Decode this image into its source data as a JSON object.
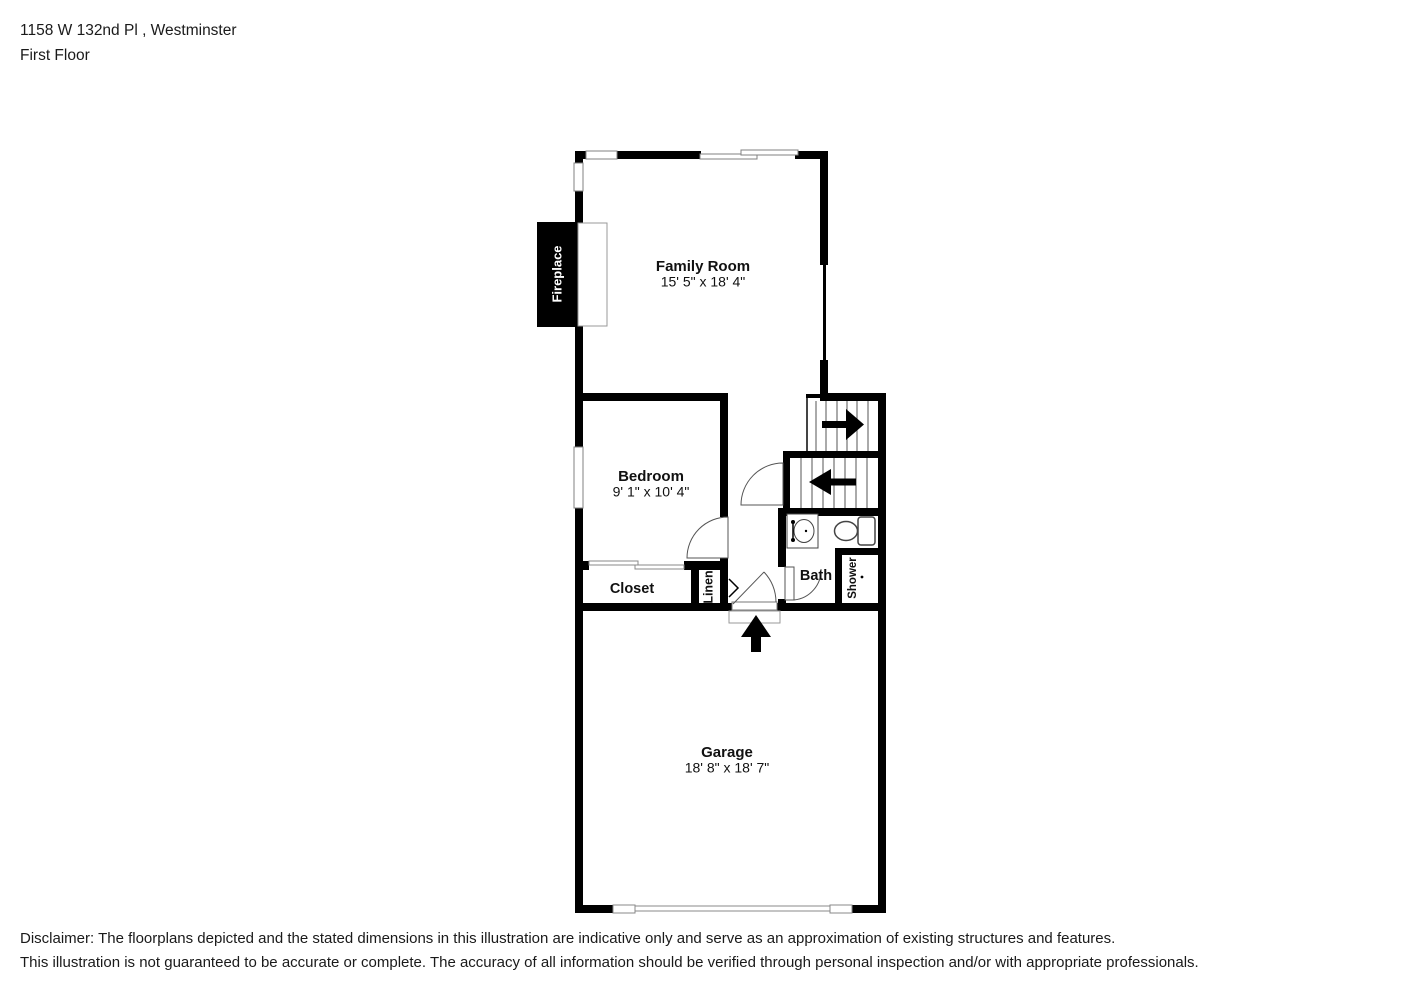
{
  "header": {
    "address": "1158 W 132nd Pl , Westminster",
    "floor": "First Floor"
  },
  "rooms": {
    "family_room": {
      "name": "Family Room",
      "dims": "15' 5\" x 18' 4\""
    },
    "bedroom": {
      "name": "Bedroom",
      "dims": "9' 1\" x 10' 4\""
    },
    "garage": {
      "name": "Garage",
      "dims": "18' 8\" x 18' 7\""
    }
  },
  "areas": {
    "fireplace": "Fireplace",
    "closet": "Closet",
    "linen": "Linen",
    "bath": "Bath",
    "shower": "Shower"
  },
  "symbols": {
    "stairs_up": "arrow-right",
    "stairs_down": "arrow-left",
    "entry": "arrow-up",
    "fixtures": [
      "sink",
      "toilet",
      "shower-stall",
      "fireplace-hearth",
      "door-arc",
      "window",
      "closet-sliding-door",
      "garage-door"
    ]
  },
  "colors": {
    "wall": "#000000",
    "background": "#ffffff",
    "text": "#111111"
  },
  "disclaimer": {
    "line1": "Disclaimer: The floorplans depicted and the stated dimensions in this illustration are indicative only and serve as an approximation of existing structures and features.",
    "line2": "This illustration is not guaranteed to be accurate or complete. The accuracy of all information should be verified through personal inspection and/or with appropriate professionals."
  }
}
